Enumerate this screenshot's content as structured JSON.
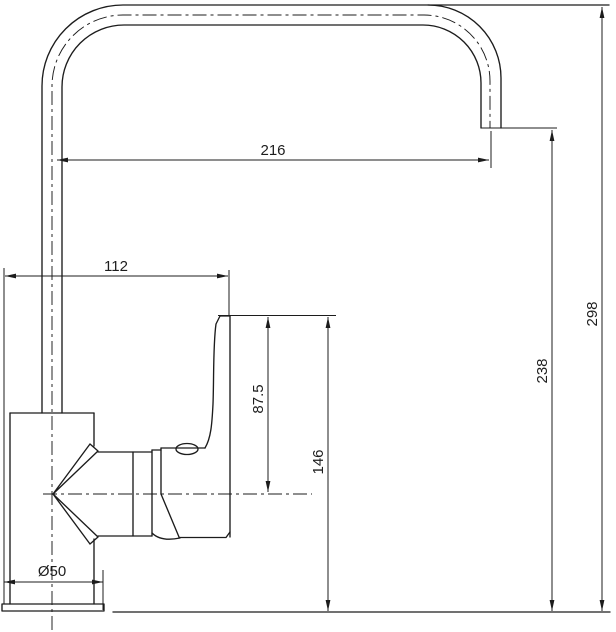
{
  "drawing": {
    "background": "#ffffff",
    "line_color": "#1c1c1c",
    "dimensions": {
      "spout_reach": {
        "label": "216"
      },
      "body_width": {
        "label": "112"
      },
      "total_height": {
        "label": "298"
      },
      "outlet_height": {
        "label": "238"
      },
      "handle_height": {
        "label": "146"
      },
      "handle_to_axis": {
        "label": "87.5"
      },
      "base_diameter": {
        "label": "Ø50"
      }
    }
  }
}
